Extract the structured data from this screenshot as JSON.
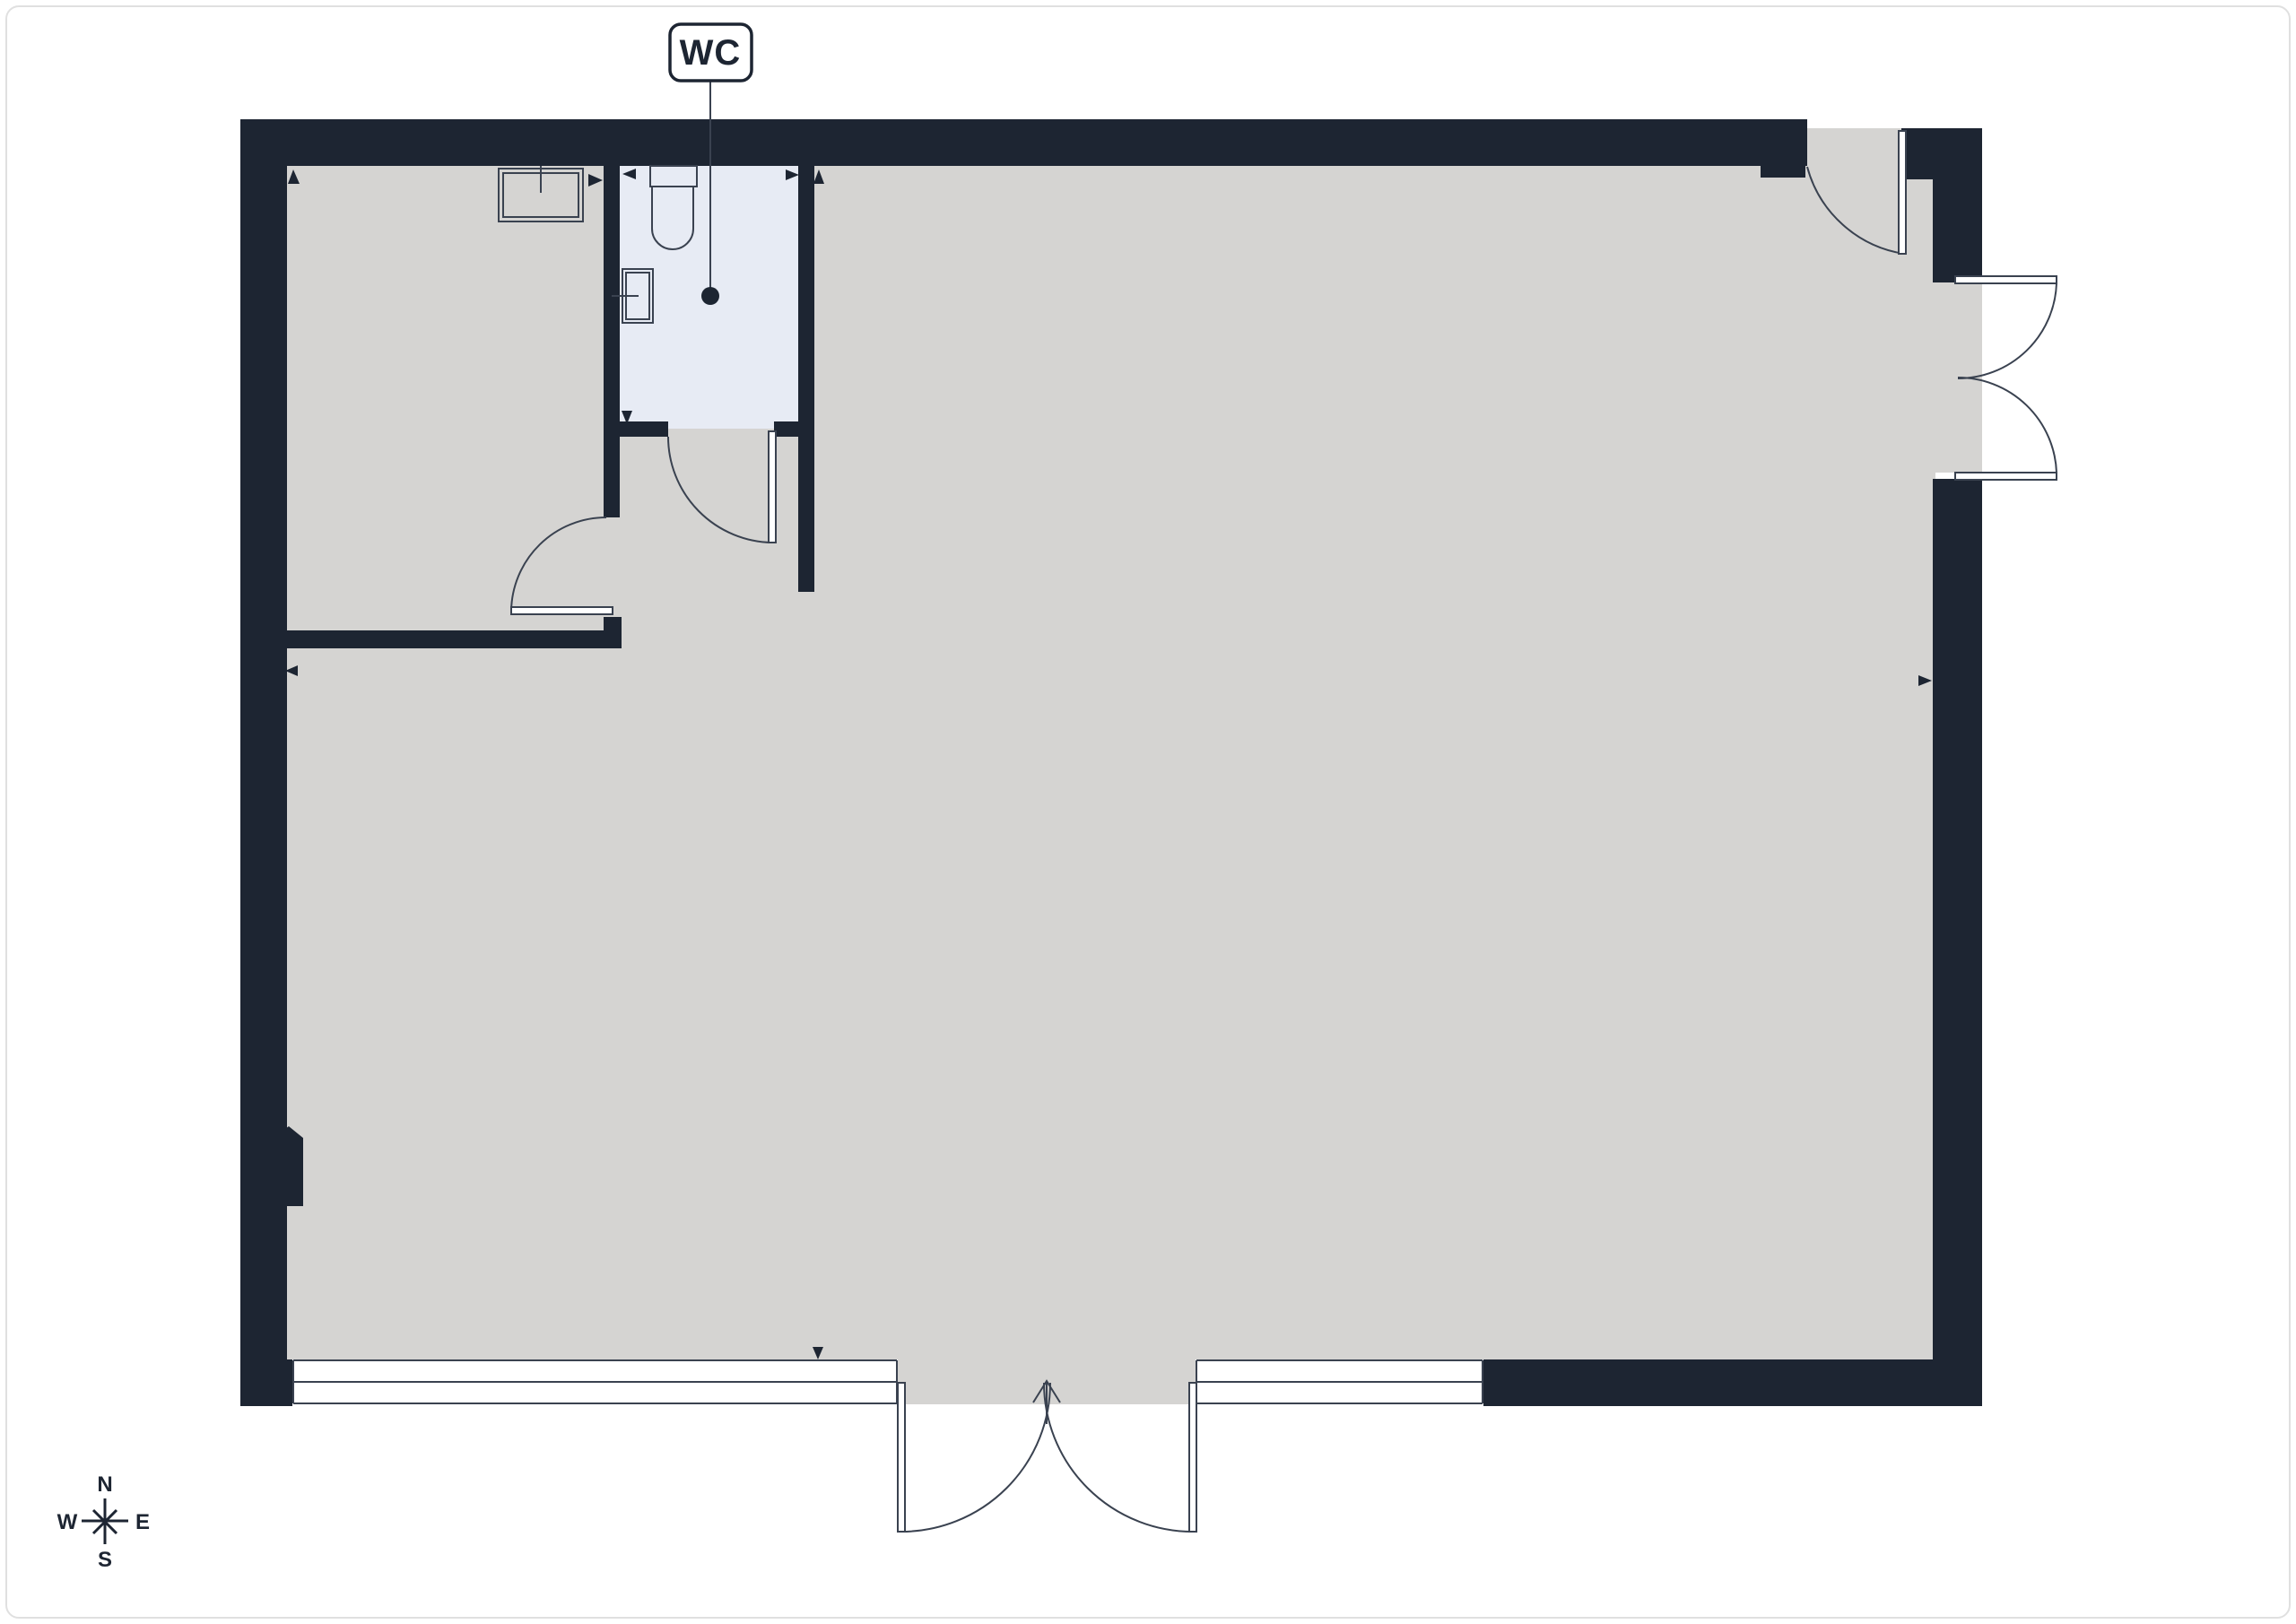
{
  "page": {
    "type": "architectural-floor-plan",
    "floors_shown": 1
  },
  "wc_label": "WC",
  "compass": {
    "n": "N",
    "e": "E",
    "s": "S",
    "w": "W"
  },
  "colors": {
    "wall": "#1d2532",
    "floor": "#d5d4d2",
    "wc_floor": "#e7ebf4",
    "line": "#3a4250",
    "door_fill": "#ffffff",
    "background": "#ffffff",
    "frame_border": "#e0e0e0"
  },
  "rooms": [
    {
      "name": "main-room",
      "floor_color": "#d5d4d2"
    },
    {
      "name": "secondary-room-top-left",
      "floor_color": "#d5d4d2"
    },
    {
      "name": "wc",
      "floor_color": "#e7ebf4",
      "label": "WC",
      "fixtures": [
        "toilet",
        "sink",
        "ceiling-point"
      ]
    }
  ],
  "openings": {
    "doors": [
      "wc-door-single-swing",
      "top-left-room-door-single-swing",
      "top-right-door-single-swing",
      "right-wall-double-french-door",
      "bottom-entrance-double-door-with-entry-arrow"
    ],
    "windows": [
      "bottom-left-window-strip",
      "bottom-right-window-strip"
    ]
  }
}
